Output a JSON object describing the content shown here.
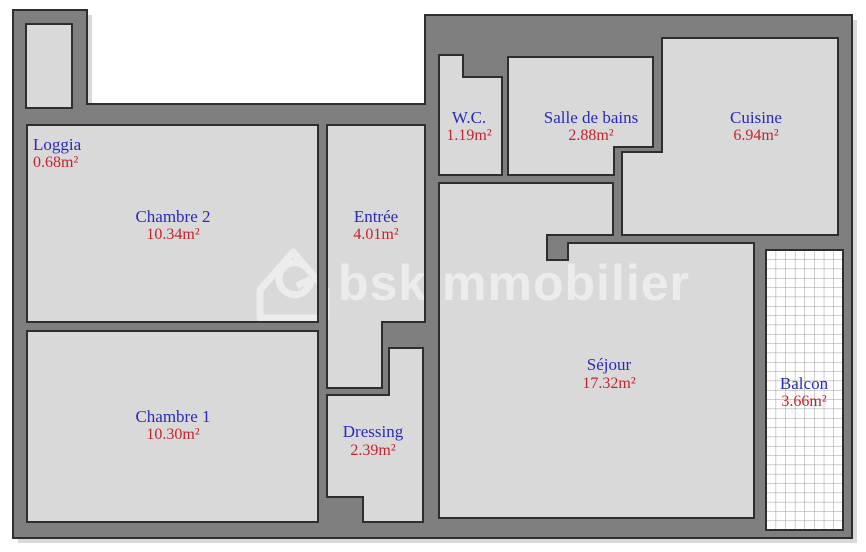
{
  "title": "Plan d'appartement",
  "watermark": {
    "text": "bskimmobilier"
  },
  "colors": {
    "wall": "#7f7f7f",
    "outline": "#2e2e2e",
    "room_name": "#2a2ab8",
    "room_area": "#c3242c",
    "watermark": "#ececec",
    "shadow": "#d9d9d9",
    "grid_line": "#9a9a9a",
    "paper": "#ffffff"
  },
  "rooms": [
    {
      "name": "Loggia",
      "area": "0.68m²"
    },
    {
      "name": "Chambre 2",
      "area": "10.34m²"
    },
    {
      "name": "Entrée",
      "area": "4.01m²"
    },
    {
      "name": "W.C.",
      "area": "1.19m²"
    },
    {
      "name": "Salle de bains",
      "area": "2.88m²"
    },
    {
      "name": "Cuisine",
      "area": "6.94m²"
    },
    {
      "name": "Séjour",
      "area": "17.32m²"
    },
    {
      "name": "Balcon",
      "area": "3.66m²"
    },
    {
      "name": "Chambre 1",
      "area": "10.30m²"
    },
    {
      "name": "Dressing",
      "area": "2.39m²"
    }
  ]
}
